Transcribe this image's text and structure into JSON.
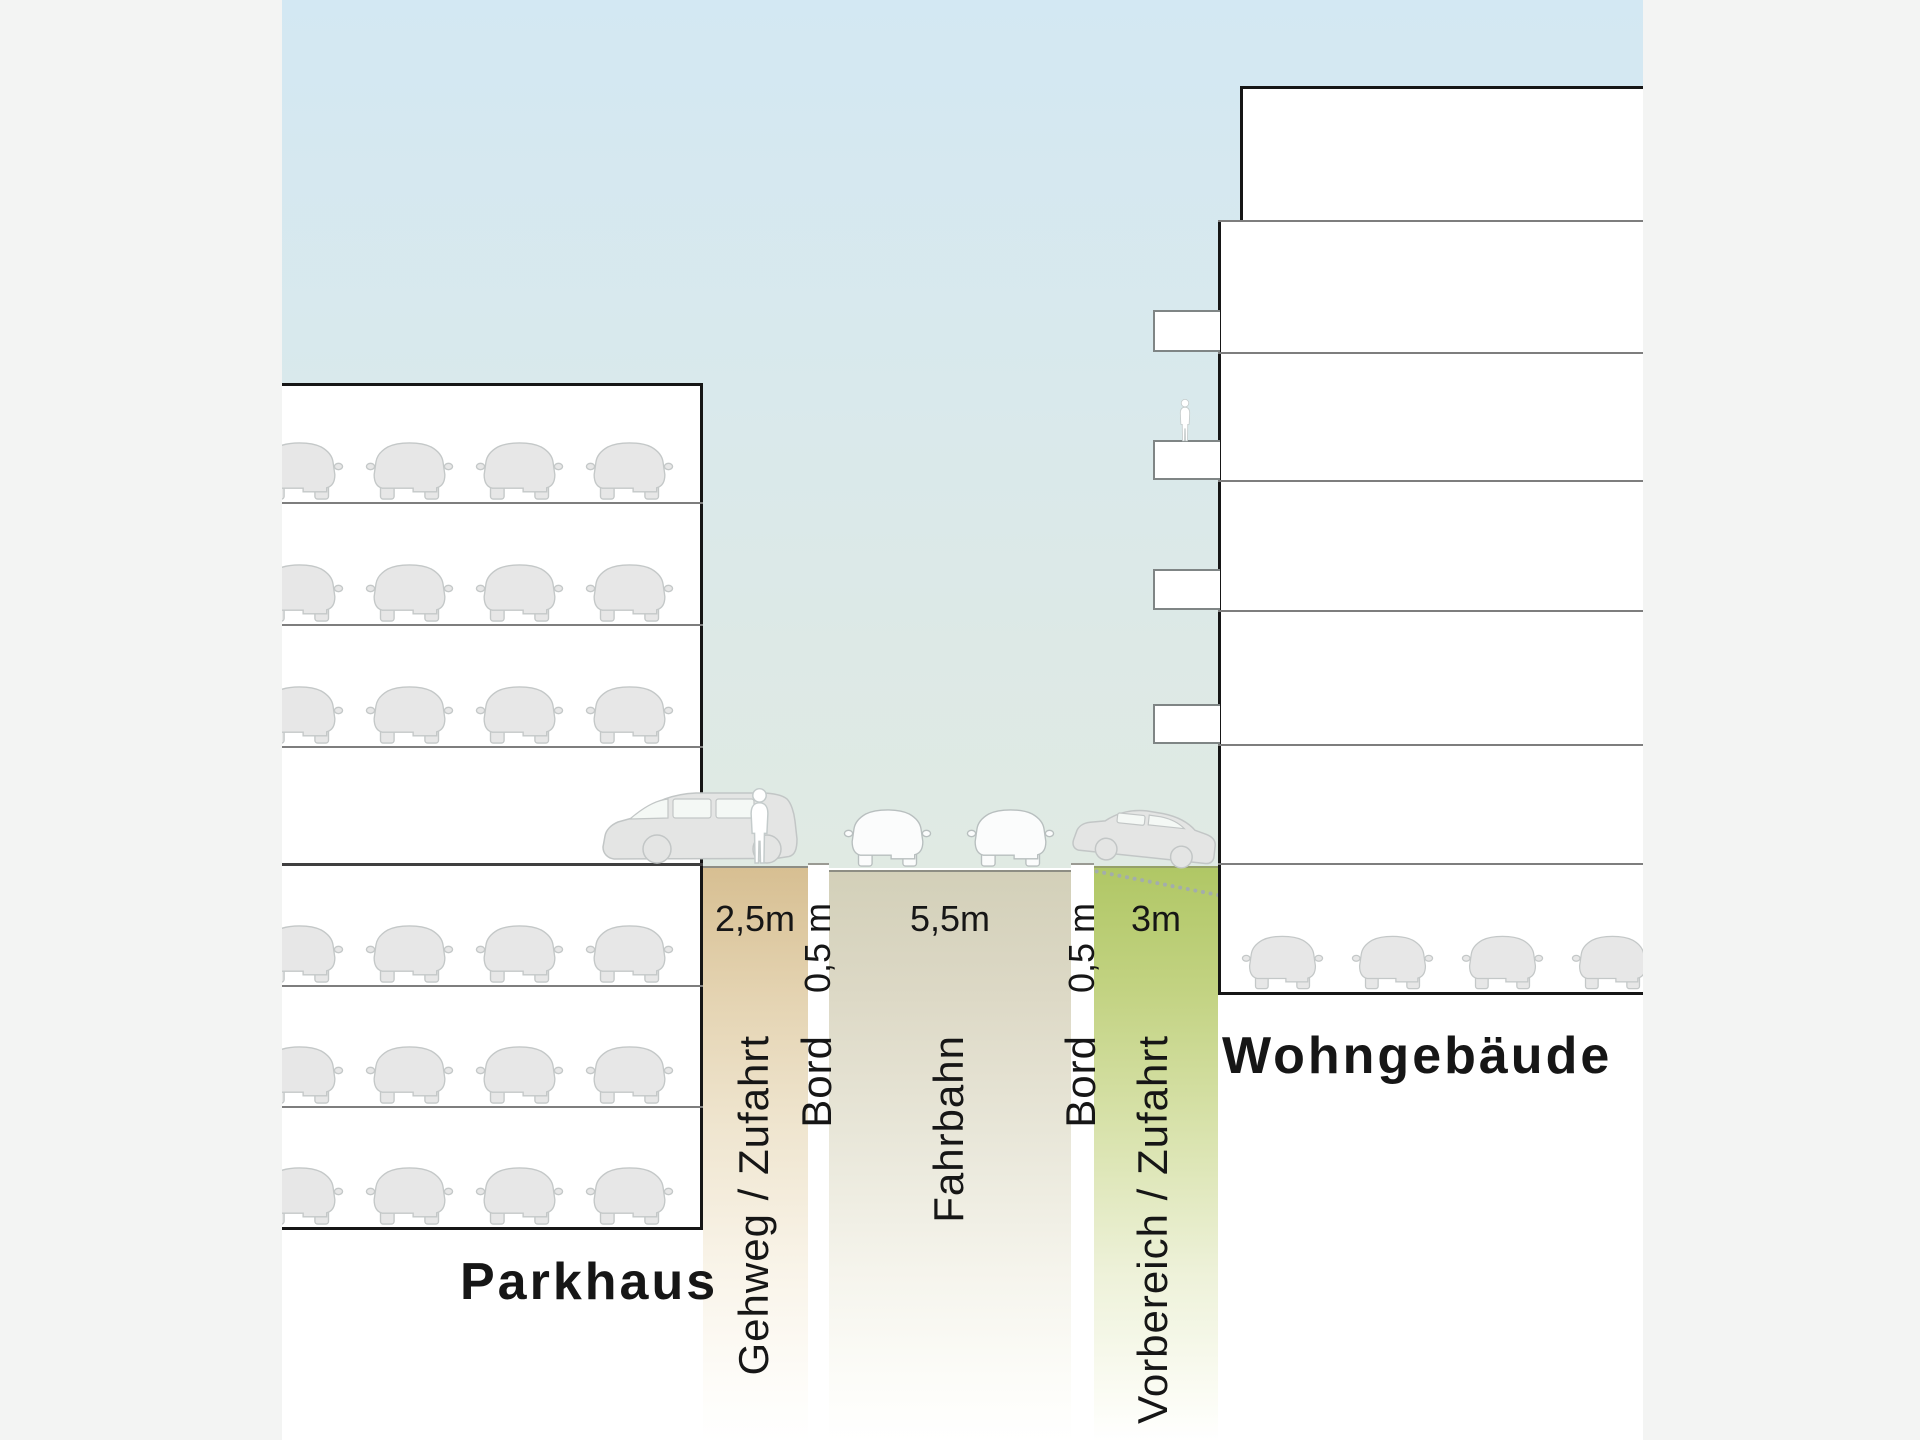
{
  "page": {
    "background": "#f3f4f3"
  },
  "diagram": {
    "type": "street-cross-section",
    "sky": {
      "top_color": "#d3e8f3",
      "bottom_color": "#e0eae3"
    },
    "buildings": {
      "parkhaus": {
        "label": "Parkhaus",
        "car_rows": 6,
        "cars_per_row": 4
      },
      "wohngebaeude": {
        "label": "Wohngebäude",
        "balcony_count": 4,
        "garage_car_count": 4,
        "residents_visible": 1
      }
    },
    "street": {
      "zones": [
        {
          "name": "gehweg-zufahrt",
          "label": "Gehweg / Zufahrt",
          "width_label": "2,5m",
          "color": "#d7bf92"
        },
        {
          "name": "bord-left",
          "label": "Bord",
          "width_label": "0,5 m",
          "color": "#ffffff"
        },
        {
          "name": "fahrbahn",
          "label": "Fahrbahn",
          "width_label": "5,5m",
          "color": "#d3d0b9"
        },
        {
          "name": "bord-right",
          "label": "Bord",
          "width_label": "0,5 m",
          "color": "#ffffff"
        },
        {
          "name": "vorbereich-zufahrt",
          "label": "Vorbereich / Zufahrt",
          "width_label": "3m",
          "color": "#b0c765"
        }
      ],
      "vehicles": {
        "fahrbahn_cars": 2,
        "van": 1,
        "ramp_car": 1
      },
      "pedestrians": 1
    }
  }
}
